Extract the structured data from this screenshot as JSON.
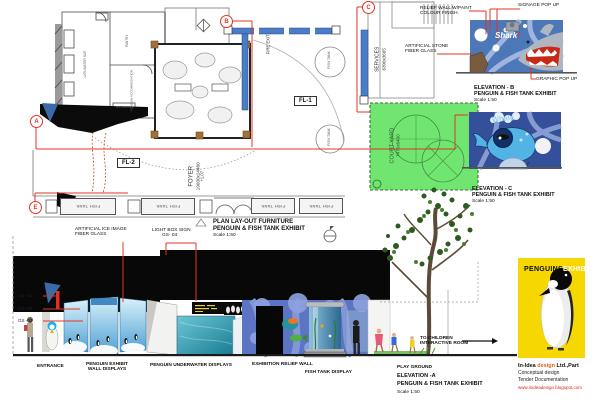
{
  "colors": {
    "annotation_red": "#e23424",
    "courtyard_green": "#70e670",
    "plan_wall_blue": "#4a7cc8",
    "poster_yellow": "#f6d800",
    "credits_accent_orange": "#e86010",
    "website_red": "#d02820"
  },
  "annotations_top": {
    "relief_wall_1": "RELIEF WALL W/PAINT",
    "relief_wall_2": "COLOUR FINISH.",
    "signage": "SIGNAGE  POP UP",
    "artificial_stone_1": "ARTIFICIAL STONE",
    "artificial_stone_2": "FIBER GLASS",
    "graphic": "GRAPHIC  POP UP"
  },
  "plan": {
    "markers": {
      "a": "A",
      "b": "B",
      "c": "C",
      "e": "E"
    },
    "fl1": "FL-1",
    "fl2": "FL-2",
    "fire_exit": "FIRE EXIT",
    "services_1": "SERVICES",
    "services_2": "6300x3665",
    "foyer_1": "FOYER",
    "foyer_2": "19000x24460",
    "foyer_3": "+1.07",
    "courtyard_1": "COURT YARD",
    "courtyard_2": "7470x6400",
    "fish_tank": "FISH TANK",
    "room_locker": "LKR./WATER SUP.",
    "room_pantry": "PANTRY",
    "room_accom": "PENGUIN ACCOMMODATION",
    "room_pool": "WATER POOL",
    "caption_1": "PLAN LAY-OUT FURNITURE",
    "caption_2": "PENGUIN & FISH TANK EXHIBIT",
    "caption_scale": "Scale 1:50"
  },
  "elevation_b": {
    "art_text": "Shark",
    "art_bang": "!",
    "title": "ELEVATION - B",
    "subtitle": "PENGUIN & FISH TANK EXHIBIT",
    "scale": "Scale 1:50"
  },
  "elevation_c": {
    "art_text": "Whale",
    "title": "ELEVATION - C",
    "subtitle": "PENGUIN & FISH TANK EXHIBIT",
    "scale": "Scale 1:50"
  },
  "elevation_a": {
    "ice_label_1": "ARTIFICIAL ICE IMAGE",
    "ice_label_2": "FIBER GLASS",
    "lightbox_label_1": "LIGHT BOX SIGN",
    "lightbox_label_2": "GS- 04",
    "gs_01": "GS -01",
    "gs_02": "GS -02",
    "gs_03": "GS -03",
    "cap_entrance": "ENTRANCE",
    "cap_wall_1": "PENGUIN EXHIBIT",
    "cap_wall_2": "WALL DISPLAYS",
    "cap_underwater": "PENGUIN UNDERWATER DISPLAYS",
    "cap_relief": "EXHIBITION RELIEF WALL",
    "cap_tank": "FISH TANK DISPLAY",
    "children_1": "TO CHILDREN",
    "children_2": "INTERACTIVE ROOM",
    "cap_playground": "PLAY GROUND",
    "title": "ELEVATION -A",
    "subtitle": "PENGUIN & FISH TANK EXHIBIT",
    "scale": "Scale 1:50"
  },
  "poster": {
    "title_black": "PENGUINS",
    "title_white": "EXHIBIT"
  },
  "credits": {
    "l1a": "In-Idea ",
    "l1b": "design",
    "l1c": " Ltd.,Part",
    "l2": "Conceptual design",
    "l3": "Tender Documentation",
    "l4": "www.inideadesign.blogspot.com"
  }
}
